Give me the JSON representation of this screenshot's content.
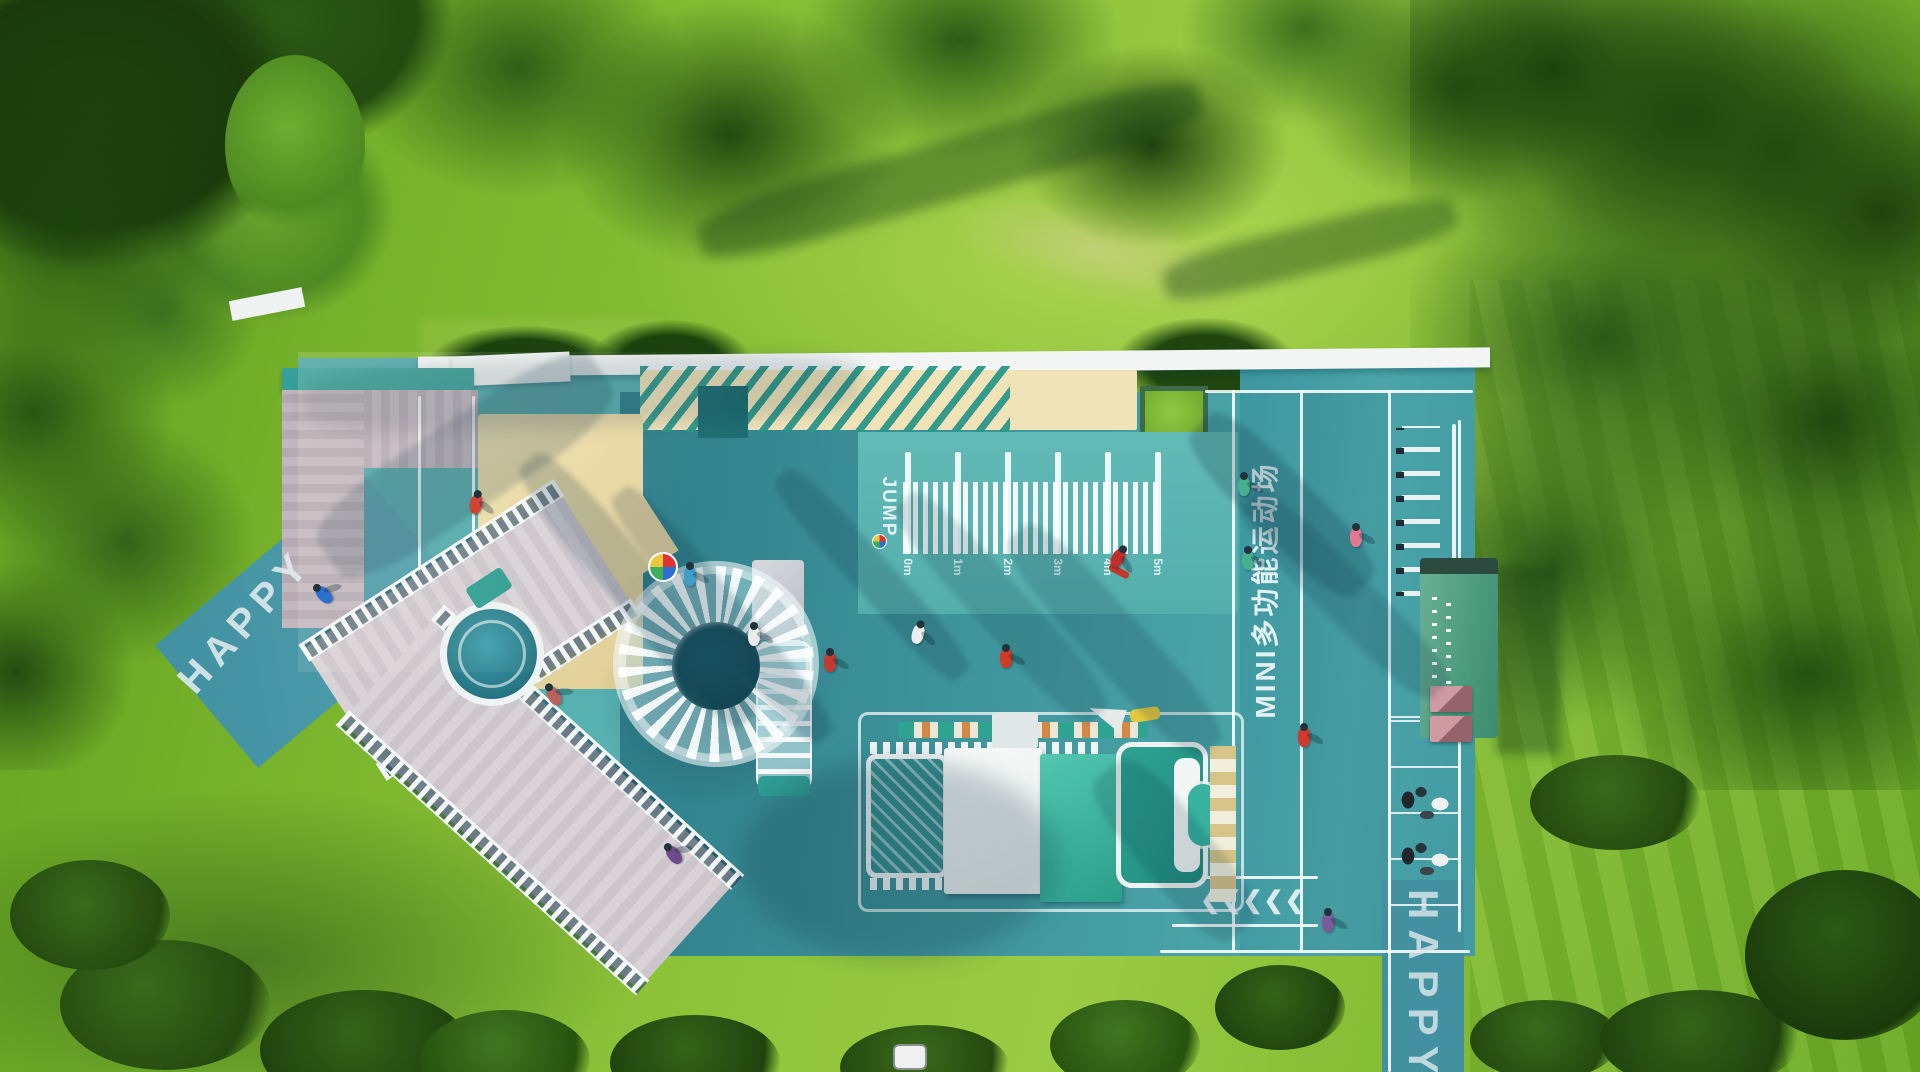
{
  "labels": {
    "happy_left": "HAPPY",
    "happy_right": "HAPPY",
    "jump": "JUMP",
    "court_title": "MINI多功能运动场",
    "chevrons": "❮❮❮❮❮"
  },
  "ruler": {
    "unit_ticks": [
      "0m",
      "1m",
      "2m",
      "3m",
      "4m",
      "5m"
    ]
  },
  "palette": {
    "grass_bright": "#8fc43a",
    "grass_dark": "#5f9e1f",
    "tree_dark": "#24500f",
    "teal_court": "#4aa2a6",
    "teal_dark_zone": "#2e7e8a",
    "teal_light_court": "#5cb5b2",
    "sand": "#e9d8a6",
    "deck_plank": "#d5ced3",
    "wall_white": "#f2f5f4",
    "truck_teal": "#2ea392",
    "pavilion_green": "#4e9c7f",
    "accent_red": "#d0392c",
    "planter_green": "#84bf3b"
  }
}
